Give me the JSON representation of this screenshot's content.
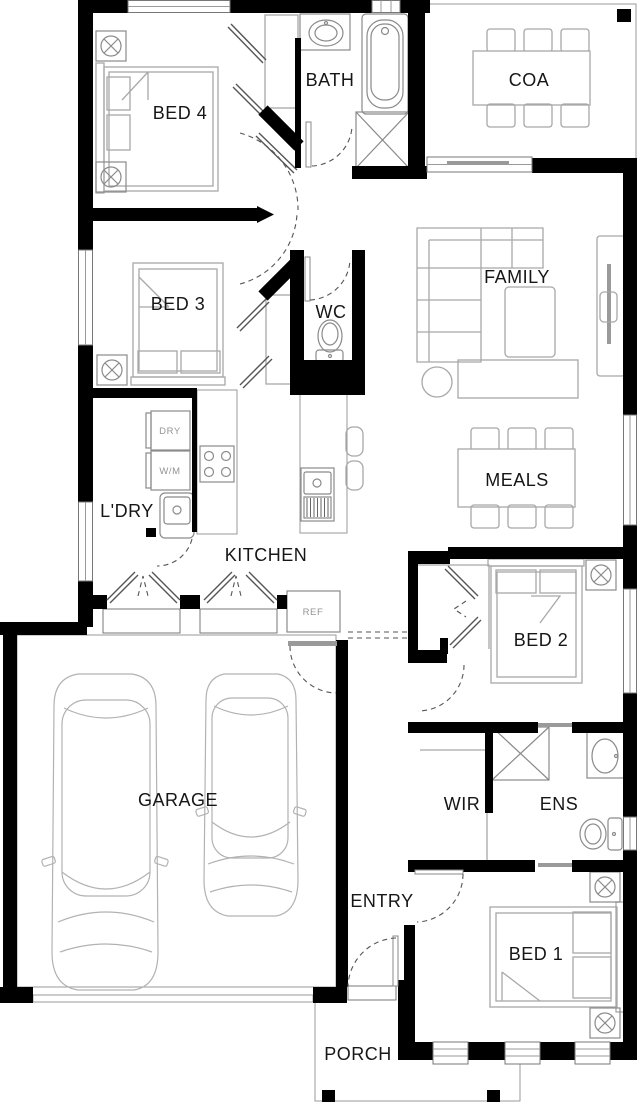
{
  "rooms": {
    "bed4": "BED 4",
    "bath": "BATH",
    "coa": "COA",
    "bed3": "BED 3",
    "wc": "WC",
    "family": "FAMILY",
    "ldry": "L'DRY",
    "kitchen": "KITCHEN",
    "meals": "MEALS",
    "bed2": "BED 2",
    "garage": "GARAGE",
    "wir": "WIR",
    "ens": "ENS",
    "entry": "ENTRY",
    "bed1": "BED 1",
    "porch": "PORCH"
  },
  "appliances": {
    "dryer": "DRY",
    "washer": "W/M",
    "fridge": "REF"
  },
  "icons": {
    "ceiling_fan": "circle-with-cross-in-square"
  },
  "colors": {
    "wall": "#000000",
    "furniture_outline": "#a8a8a8",
    "fixture_outline": "#8a8a8a",
    "door_swing": "#555555",
    "label_text": "#161616",
    "appliance_text": "#949494",
    "background": "#ffffff"
  }
}
